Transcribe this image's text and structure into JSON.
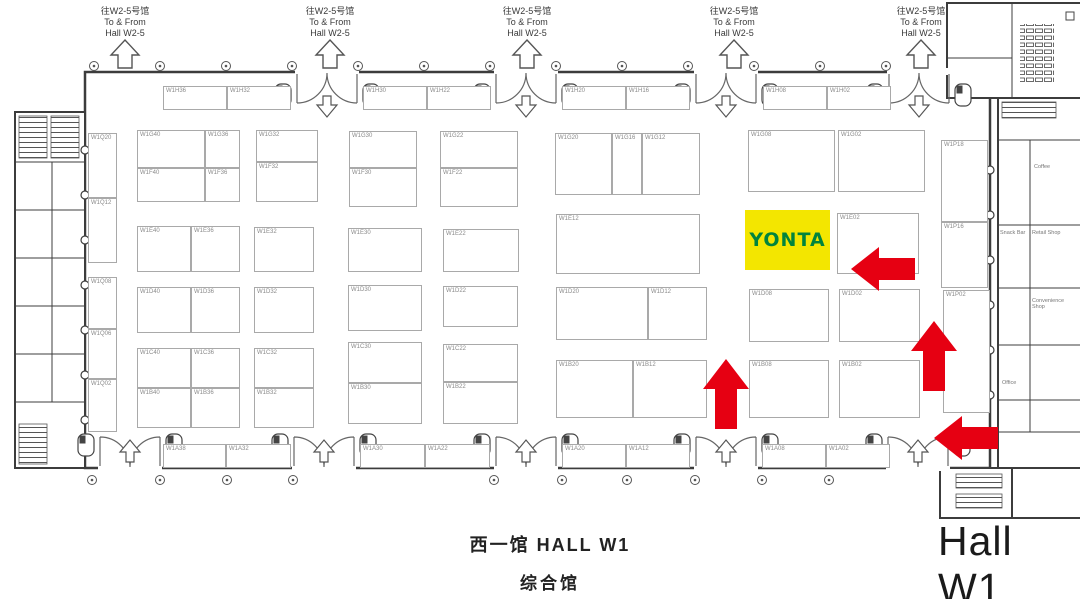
{
  "colors": {
    "arrow_red": "#e60012",
    "booth_yellow": "#f3e600",
    "logo_green": "#00843d",
    "wall": "#3c3c3c",
    "booth_border": "#a9a9a9",
    "label_gray": "#8a8a8a"
  },
  "exit_sign": {
    "line1": "往W2-5号馆",
    "line2": "To & From",
    "line3": "Hall W2-5"
  },
  "titles": {
    "hall_cn": "西一馆 HALL W1",
    "hall_type_cn": "综合馆",
    "hall_en": "Hall W1"
  },
  "highlight": {
    "logo_text": "YONTA"
  },
  "floorplan": {
    "highlight_booth": {
      "x": 745,
      "y": 210,
      "w": 85,
      "h": 60
    },
    "booths": [
      {
        "label": "W1H36",
        "x": 163,
        "y": 86,
        "w": 64,
        "h": 24
      },
      {
        "label": "W1H32",
        "x": 227,
        "y": 86,
        "w": 64,
        "h": 24
      },
      {
        "label": "W1H30",
        "x": 363,
        "y": 86,
        "w": 64,
        "h": 24
      },
      {
        "label": "W1H22",
        "x": 427,
        "y": 86,
        "w": 64,
        "h": 24
      },
      {
        "label": "W1H20",
        "x": 562,
        "y": 86,
        "w": 64,
        "h": 24
      },
      {
        "label": "W1H16",
        "x": 626,
        "y": 86,
        "w": 64,
        "h": 24
      },
      {
        "label": "W1H08",
        "x": 763,
        "y": 86,
        "w": 64,
        "h": 24
      },
      {
        "label": "W1H02",
        "x": 827,
        "y": 86,
        "w": 64,
        "h": 24
      },
      {
        "label": "W1G40",
        "x": 137,
        "y": 130,
        "w": 68,
        "h": 38
      },
      {
        "label": "W1G36",
        "x": 205,
        "y": 130,
        "w": 35,
        "h": 38
      },
      {
        "label": "W1F40",
        "x": 137,
        "y": 168,
        "w": 68,
        "h": 34
      },
      {
        "label": "W1F36",
        "x": 205,
        "y": 168,
        "w": 35,
        "h": 34
      },
      {
        "label": "W1G32",
        "x": 256,
        "y": 130,
        "w": 62,
        "h": 32
      },
      {
        "label": "W1F32",
        "x": 256,
        "y": 162,
        "w": 62,
        "h": 40
      },
      {
        "label": "W1G30",
        "x": 349,
        "y": 131,
        "w": 68,
        "h": 37
      },
      {
        "label": "W1F30",
        "x": 349,
        "y": 168,
        "w": 68,
        "h": 39
      },
      {
        "label": "W1G22",
        "x": 440,
        "y": 131,
        "w": 78,
        "h": 37
      },
      {
        "label": "W1F22",
        "x": 440,
        "y": 168,
        "w": 78,
        "h": 39
      },
      {
        "label": "W1G20",
        "x": 555,
        "y": 133,
        "w": 57,
        "h": 62
      },
      {
        "label": "W1G16",
        "x": 612,
        "y": 133,
        "w": 30,
        "h": 62
      },
      {
        "label": "W1G12",
        "x": 642,
        "y": 133,
        "w": 58,
        "h": 62
      },
      {
        "label": "W1G08",
        "x": 748,
        "y": 130,
        "w": 87,
        "h": 62
      },
      {
        "label": "W1G02",
        "x": 838,
        "y": 130,
        "w": 87,
        "h": 62
      },
      {
        "label": "W1P18",
        "x": 941,
        "y": 140,
        "w": 47,
        "h": 82
      },
      {
        "label": "W1Q20",
        "x": 88,
        "y": 133,
        "w": 29,
        "h": 65
      },
      {
        "label": "W1Q12",
        "x": 88,
        "y": 198,
        "w": 29,
        "h": 65
      },
      {
        "label": "W1E40",
        "x": 137,
        "y": 226,
        "w": 54,
        "h": 46
      },
      {
        "label": "W1E36",
        "x": 191,
        "y": 226,
        "w": 49,
        "h": 46
      },
      {
        "label": "W1E32",
        "x": 254,
        "y": 227,
        "w": 60,
        "h": 45
      },
      {
        "label": "W1E30",
        "x": 348,
        "y": 228,
        "w": 74,
        "h": 44
      },
      {
        "label": "W1E22",
        "x": 443,
        "y": 229,
        "w": 76,
        "h": 43
      },
      {
        "label": "W1E12",
        "x": 556,
        "y": 214,
        "w": 144,
        "h": 60
      },
      {
        "label": "W1E02",
        "x": 837,
        "y": 213,
        "w": 82,
        "h": 61
      },
      {
        "label": "W1P16",
        "x": 941,
        "y": 222,
        "w": 47,
        "h": 66
      },
      {
        "label": "W1Q08",
        "x": 88,
        "y": 277,
        "w": 29,
        "h": 52
      },
      {
        "label": "W1D40",
        "x": 137,
        "y": 287,
        "w": 54,
        "h": 46
      },
      {
        "label": "W1D36",
        "x": 191,
        "y": 287,
        "w": 49,
        "h": 46
      },
      {
        "label": "W1D32",
        "x": 254,
        "y": 287,
        "w": 60,
        "h": 46
      },
      {
        "label": "W1D30",
        "x": 348,
        "y": 285,
        "w": 74,
        "h": 46
      },
      {
        "label": "W1D22",
        "x": 443,
        "y": 286,
        "w": 75,
        "h": 41
      },
      {
        "label": "W1D20",
        "x": 556,
        "y": 287,
        "w": 92,
        "h": 53
      },
      {
        "label": "W1D12",
        "x": 648,
        "y": 287,
        "w": 59,
        "h": 53
      },
      {
        "label": "W1D08",
        "x": 749,
        "y": 289,
        "w": 80,
        "h": 53
      },
      {
        "label": "W1D02",
        "x": 839,
        "y": 289,
        "w": 81,
        "h": 53
      },
      {
        "label": "W1P02",
        "x": 943,
        "y": 290,
        "w": 47,
        "h": 123
      },
      {
        "label": "W1Q06",
        "x": 88,
        "y": 329,
        "w": 29,
        "h": 50
      },
      {
        "label": "W1Q02",
        "x": 88,
        "y": 379,
        "w": 29,
        "h": 53
      },
      {
        "label": "W1C40",
        "x": 137,
        "y": 348,
        "w": 54,
        "h": 40
      },
      {
        "label": "W1C36",
        "x": 191,
        "y": 348,
        "w": 49,
        "h": 40
      },
      {
        "label": "W1C32",
        "x": 254,
        "y": 348,
        "w": 60,
        "h": 40
      },
      {
        "label": "W1C30",
        "x": 348,
        "y": 342,
        "w": 74,
        "h": 41
      },
      {
        "label": "W1C22",
        "x": 443,
        "y": 344,
        "w": 75,
        "h": 38
      },
      {
        "label": "W1B40",
        "x": 137,
        "y": 388,
        "w": 54,
        "h": 40
      },
      {
        "label": "W1B36",
        "x": 191,
        "y": 388,
        "w": 49,
        "h": 40
      },
      {
        "label": "W1B32",
        "x": 254,
        "y": 388,
        "w": 60,
        "h": 40
      },
      {
        "label": "W1B30",
        "x": 348,
        "y": 383,
        "w": 74,
        "h": 41
      },
      {
        "label": "W1B22",
        "x": 443,
        "y": 382,
        "w": 75,
        "h": 42
      },
      {
        "label": "W1B20",
        "x": 556,
        "y": 360,
        "w": 77,
        "h": 58
      },
      {
        "label": "W1B12",
        "x": 633,
        "y": 360,
        "w": 74,
        "h": 58
      },
      {
        "label": "W1B08",
        "x": 749,
        "y": 360,
        "w": 80,
        "h": 58
      },
      {
        "label": "W1B02",
        "x": 839,
        "y": 360,
        "w": 81,
        "h": 58
      },
      {
        "label": "W1A38",
        "x": 163,
        "y": 444,
        "w": 63,
        "h": 24
      },
      {
        "label": "W1A32",
        "x": 226,
        "y": 444,
        "w": 65,
        "h": 24
      },
      {
        "label": "W1A30",
        "x": 360,
        "y": 444,
        "w": 65,
        "h": 24
      },
      {
        "label": "W1A22",
        "x": 425,
        "y": 444,
        "w": 65,
        "h": 24
      },
      {
        "label": "W1A20",
        "x": 562,
        "y": 444,
        "w": 64,
        "h": 24
      },
      {
        "label": "W1A12",
        "x": 626,
        "y": 444,
        "w": 64,
        "h": 24
      },
      {
        "label": "W1A08",
        "x": 762,
        "y": 444,
        "w": 64,
        "h": 24
      },
      {
        "label": "W1A02",
        "x": 826,
        "y": 444,
        "w": 64,
        "h": 24
      }
    ],
    "side_rooms": [
      {
        "label": "Coffee",
        "x": 1034,
        "y": 164
      },
      {
        "label": "Snack Bar",
        "x": 1000,
        "y": 230
      },
      {
        "label": "Retail Shop",
        "x": 1032,
        "y": 230
      },
      {
        "label": "Convenience Shop",
        "x": 1032,
        "y": 298
      },
      {
        "label": "Office",
        "x": 1002,
        "y": 380
      }
    ],
    "route_arrows": [
      {
        "direction": "left",
        "tip_x": 851,
        "tip_y": 269
      },
      {
        "direction": "up",
        "tip_x": 726,
        "tip_y": 359
      },
      {
        "direction": "up",
        "tip_x": 934,
        "tip_y": 321
      },
      {
        "direction": "left",
        "tip_x": 934,
        "tip_y": 438
      }
    ]
  }
}
